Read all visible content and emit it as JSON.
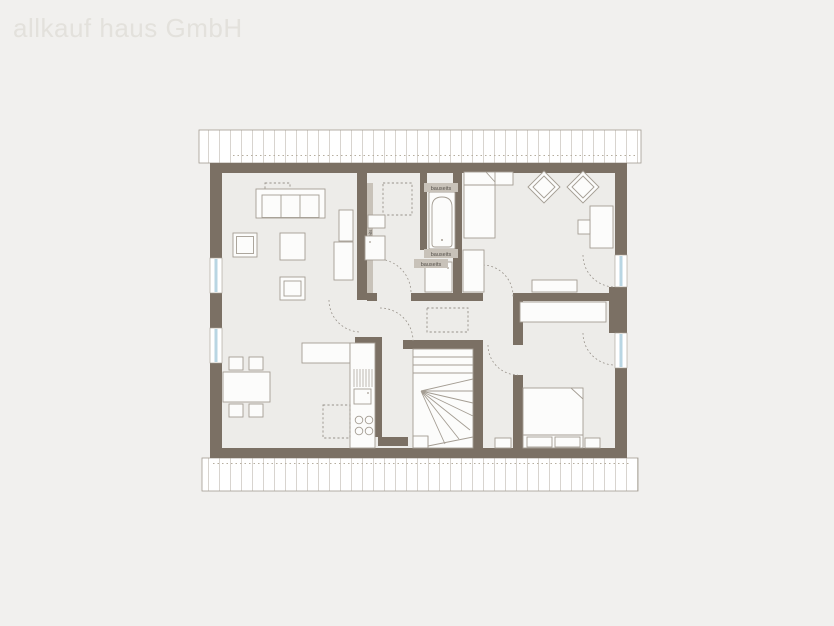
{
  "watermark": "allkauf haus GmbH",
  "annotations": {
    "bauseits_tub_top": "bauseits",
    "bauseits_tub_bottom1": "bauseits",
    "bauseits_tub_bottom2": "bauseits",
    "bauseits_wardrobe_strip": "bauseits"
  },
  "colors": {
    "bg": "#f1f0ee",
    "floor": "#edece9",
    "wall": "#7b7064",
    "stroke": "#a49d93",
    "dash": "#98928a",
    "glass": "#b9d6e3",
    "stripe": "#d8d4cf",
    "band_border": "#a29b91",
    "band_dot": "#b6ae9f",
    "label_bg": "#c8c2b9",
    "label_text": "#55504a",
    "watermark": "#e3e1dc",
    "white": "#fcfcfb"
  }
}
